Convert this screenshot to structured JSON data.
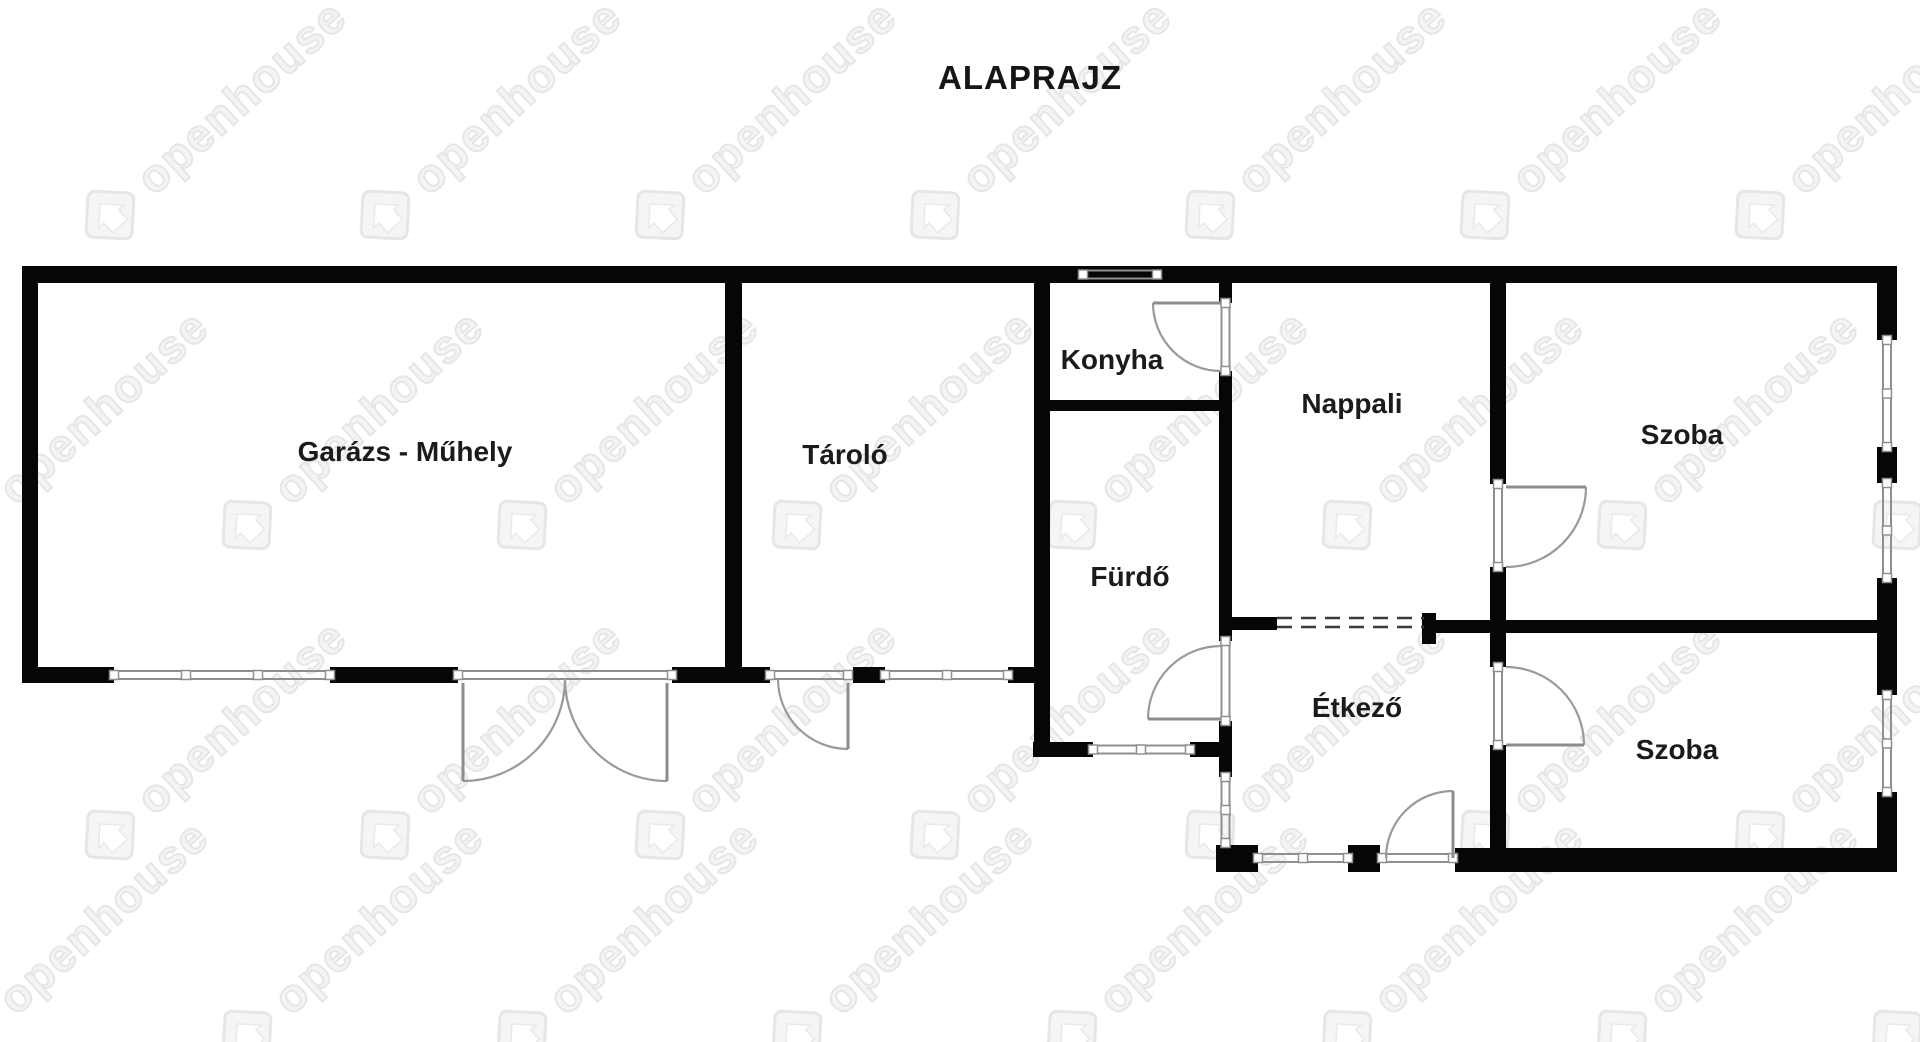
{
  "title": "ALAPRAJZ",
  "watermark": {
    "text": "openhouse",
    "icon": "openhouse-diamond-house-logo"
  },
  "floorplan": {
    "rooms": [
      {
        "id": "garage-workshop",
        "label": "Garázs - Műhely"
      },
      {
        "id": "storage",
        "label": "Tároló"
      },
      {
        "id": "kitchen",
        "label": "Konyha"
      },
      {
        "id": "bathroom",
        "label": "Fürdő"
      },
      {
        "id": "living-room",
        "label": "Nappali"
      },
      {
        "id": "room-upper",
        "label": "Szoba"
      },
      {
        "id": "dining-room",
        "label": "Étkező"
      },
      {
        "id": "room-lower",
        "label": "Szoba"
      }
    ]
  }
}
